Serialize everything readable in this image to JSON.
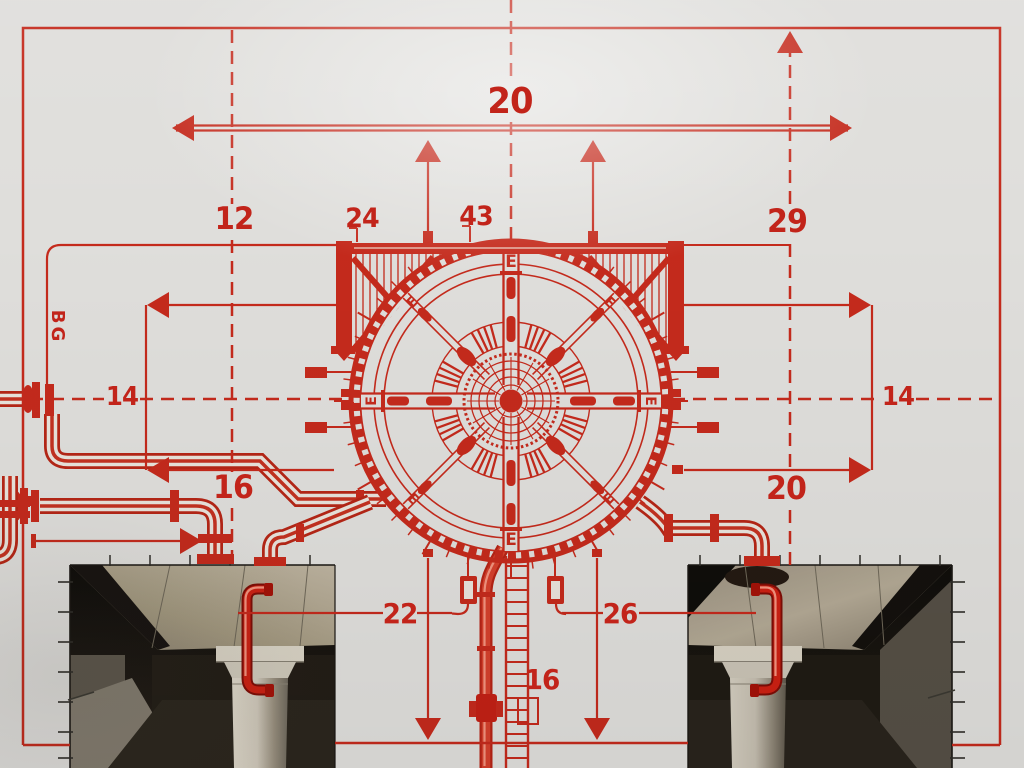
{
  "colors": {
    "red": "#c42a1c",
    "red_dark": "#9e170c",
    "red_bright": "#e0513a",
    "pipe_highlight": "#f2937e",
    "paper": "#dfdedb",
    "ink_dark": "#2e2c28"
  },
  "dimensions": {
    "top_width": "20",
    "upper_left": "12",
    "beam_left": "24",
    "beam_right": "43",
    "upper_right": "29",
    "axis_left": "14",
    "axis_right": "14",
    "mid_left": "16",
    "mid_right": "20",
    "lower_left": "22",
    "lower_right": "26",
    "shaft": "16",
    "side_code": "BG"
  },
  "wheel": {
    "marker": "E",
    "marker_positions": [
      0,
      45,
      90,
      135,
      180,
      225,
      270,
      315
    ]
  }
}
